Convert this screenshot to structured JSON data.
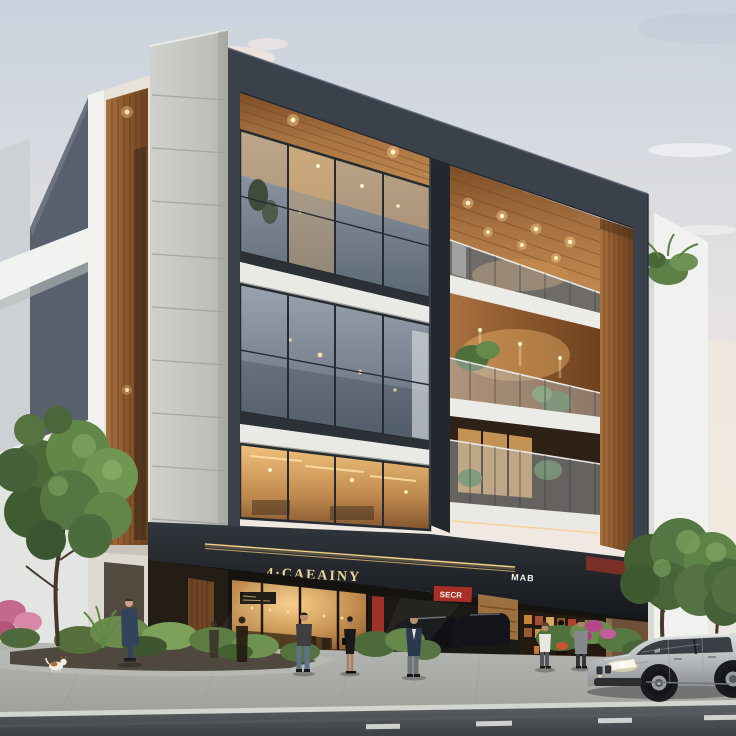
{
  "signs": {
    "cafe_fascia": "4·CAEAINY",
    "shop_fascia": "MAB",
    "shop_interior_red": "SECR"
  },
  "scene": {
    "setting": "modern four-storey mixed-use building with glass facade at dusk",
    "pedestrians": 7,
    "dog": 1,
    "vehicle": "silver sedan",
    "storefronts": [
      "cafe",
      "auto showroom",
      "retail shop"
    ]
  },
  "palette": {
    "sky_top": "#c9d2de",
    "sky_horizon": "#f0e9e3",
    "frame_charcoal": "#3a414b",
    "concrete": "#c9cac5",
    "wood": "#a9713f",
    "warm_light": "#f0c27c",
    "balcony_slab": "#ebece8",
    "road": "#46494b",
    "sign_gold": "#ecd698",
    "foliage": "#5d7c46",
    "car_silver": "#b9bcbe"
  }
}
